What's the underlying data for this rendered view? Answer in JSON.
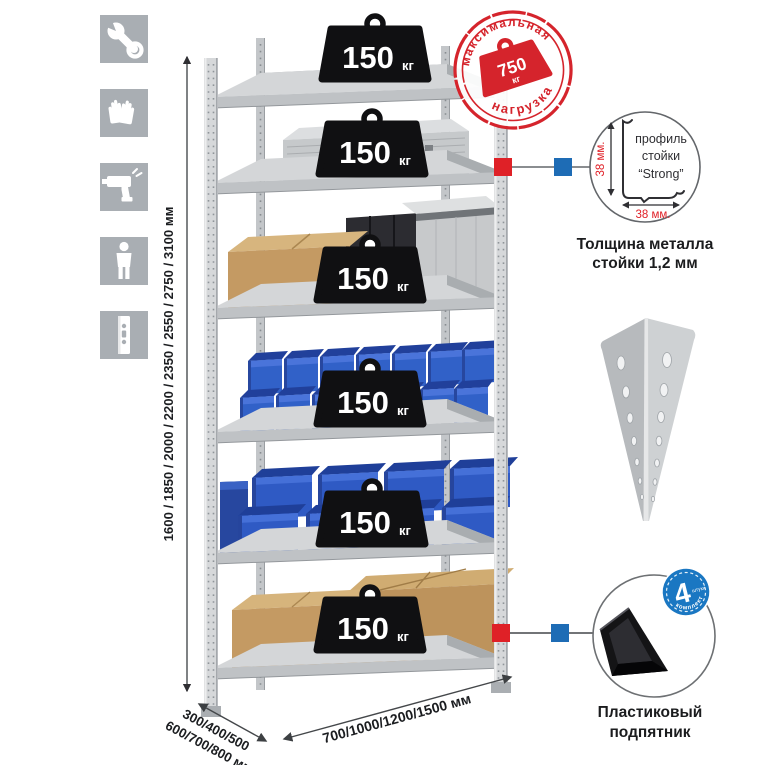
{
  "assembly_icons": {
    "items": [
      {
        "name": "wrench-icon"
      },
      {
        "name": "gloves-icon"
      },
      {
        "name": "drill-icon"
      },
      {
        "name": "person-icon"
      },
      {
        "name": "rack-upright-icon"
      }
    ]
  },
  "dimensions": {
    "height_options": "1600 / 1850 / 2000 / 2200 / 2350 / 2550 / 2750 / 3100 мм",
    "depth_options_line1": "300/400/500",
    "depth_options_line2": "600/700/800 мм",
    "width_options": "700/1000/1200/1500 мм"
  },
  "rack": {
    "shelf_count": 6,
    "shelf_load_badges": [
      {
        "value": "150",
        "unit": "кг"
      },
      {
        "value": "150",
        "unit": "кг"
      },
      {
        "value": "150",
        "unit": "кг"
      },
      {
        "value": "150",
        "unit": "кг"
      },
      {
        "value": "150",
        "unit": "кг"
      },
      {
        "value": "150",
        "unit": "кг"
      }
    ]
  },
  "max_load_stamp": {
    "arc_top": "максимальная",
    "arc_bottom": "нагрузка",
    "value": "750",
    "unit": "кг",
    "color": "#d5242c"
  },
  "profile_detail": {
    "label_line1": "профиль",
    "label_line2": "стойки",
    "label_line3": "“Strong”",
    "vertical_dim": "38 мм.",
    "horizontal_dim": "38 мм.",
    "caption_line1": "Толщина металла",
    "caption_line2": "стойки 1,2 мм"
  },
  "foot_detail": {
    "count_badge": {
      "number": "4",
      "unit_word": "штуки",
      "arc_text": "в комплекте",
      "color": "#1a77c2"
    },
    "caption_line1": "Пластиковый",
    "caption_line2": "подпятник"
  },
  "colors": {
    "marker_red": "#df2127",
    "marker_blue": "#1e6cb5",
    "bin_blue": "#3161c8",
    "stamp_red": "#d5242c",
    "metal": "#cfd2d4",
    "icon_tile": "#a9aeb3"
  }
}
